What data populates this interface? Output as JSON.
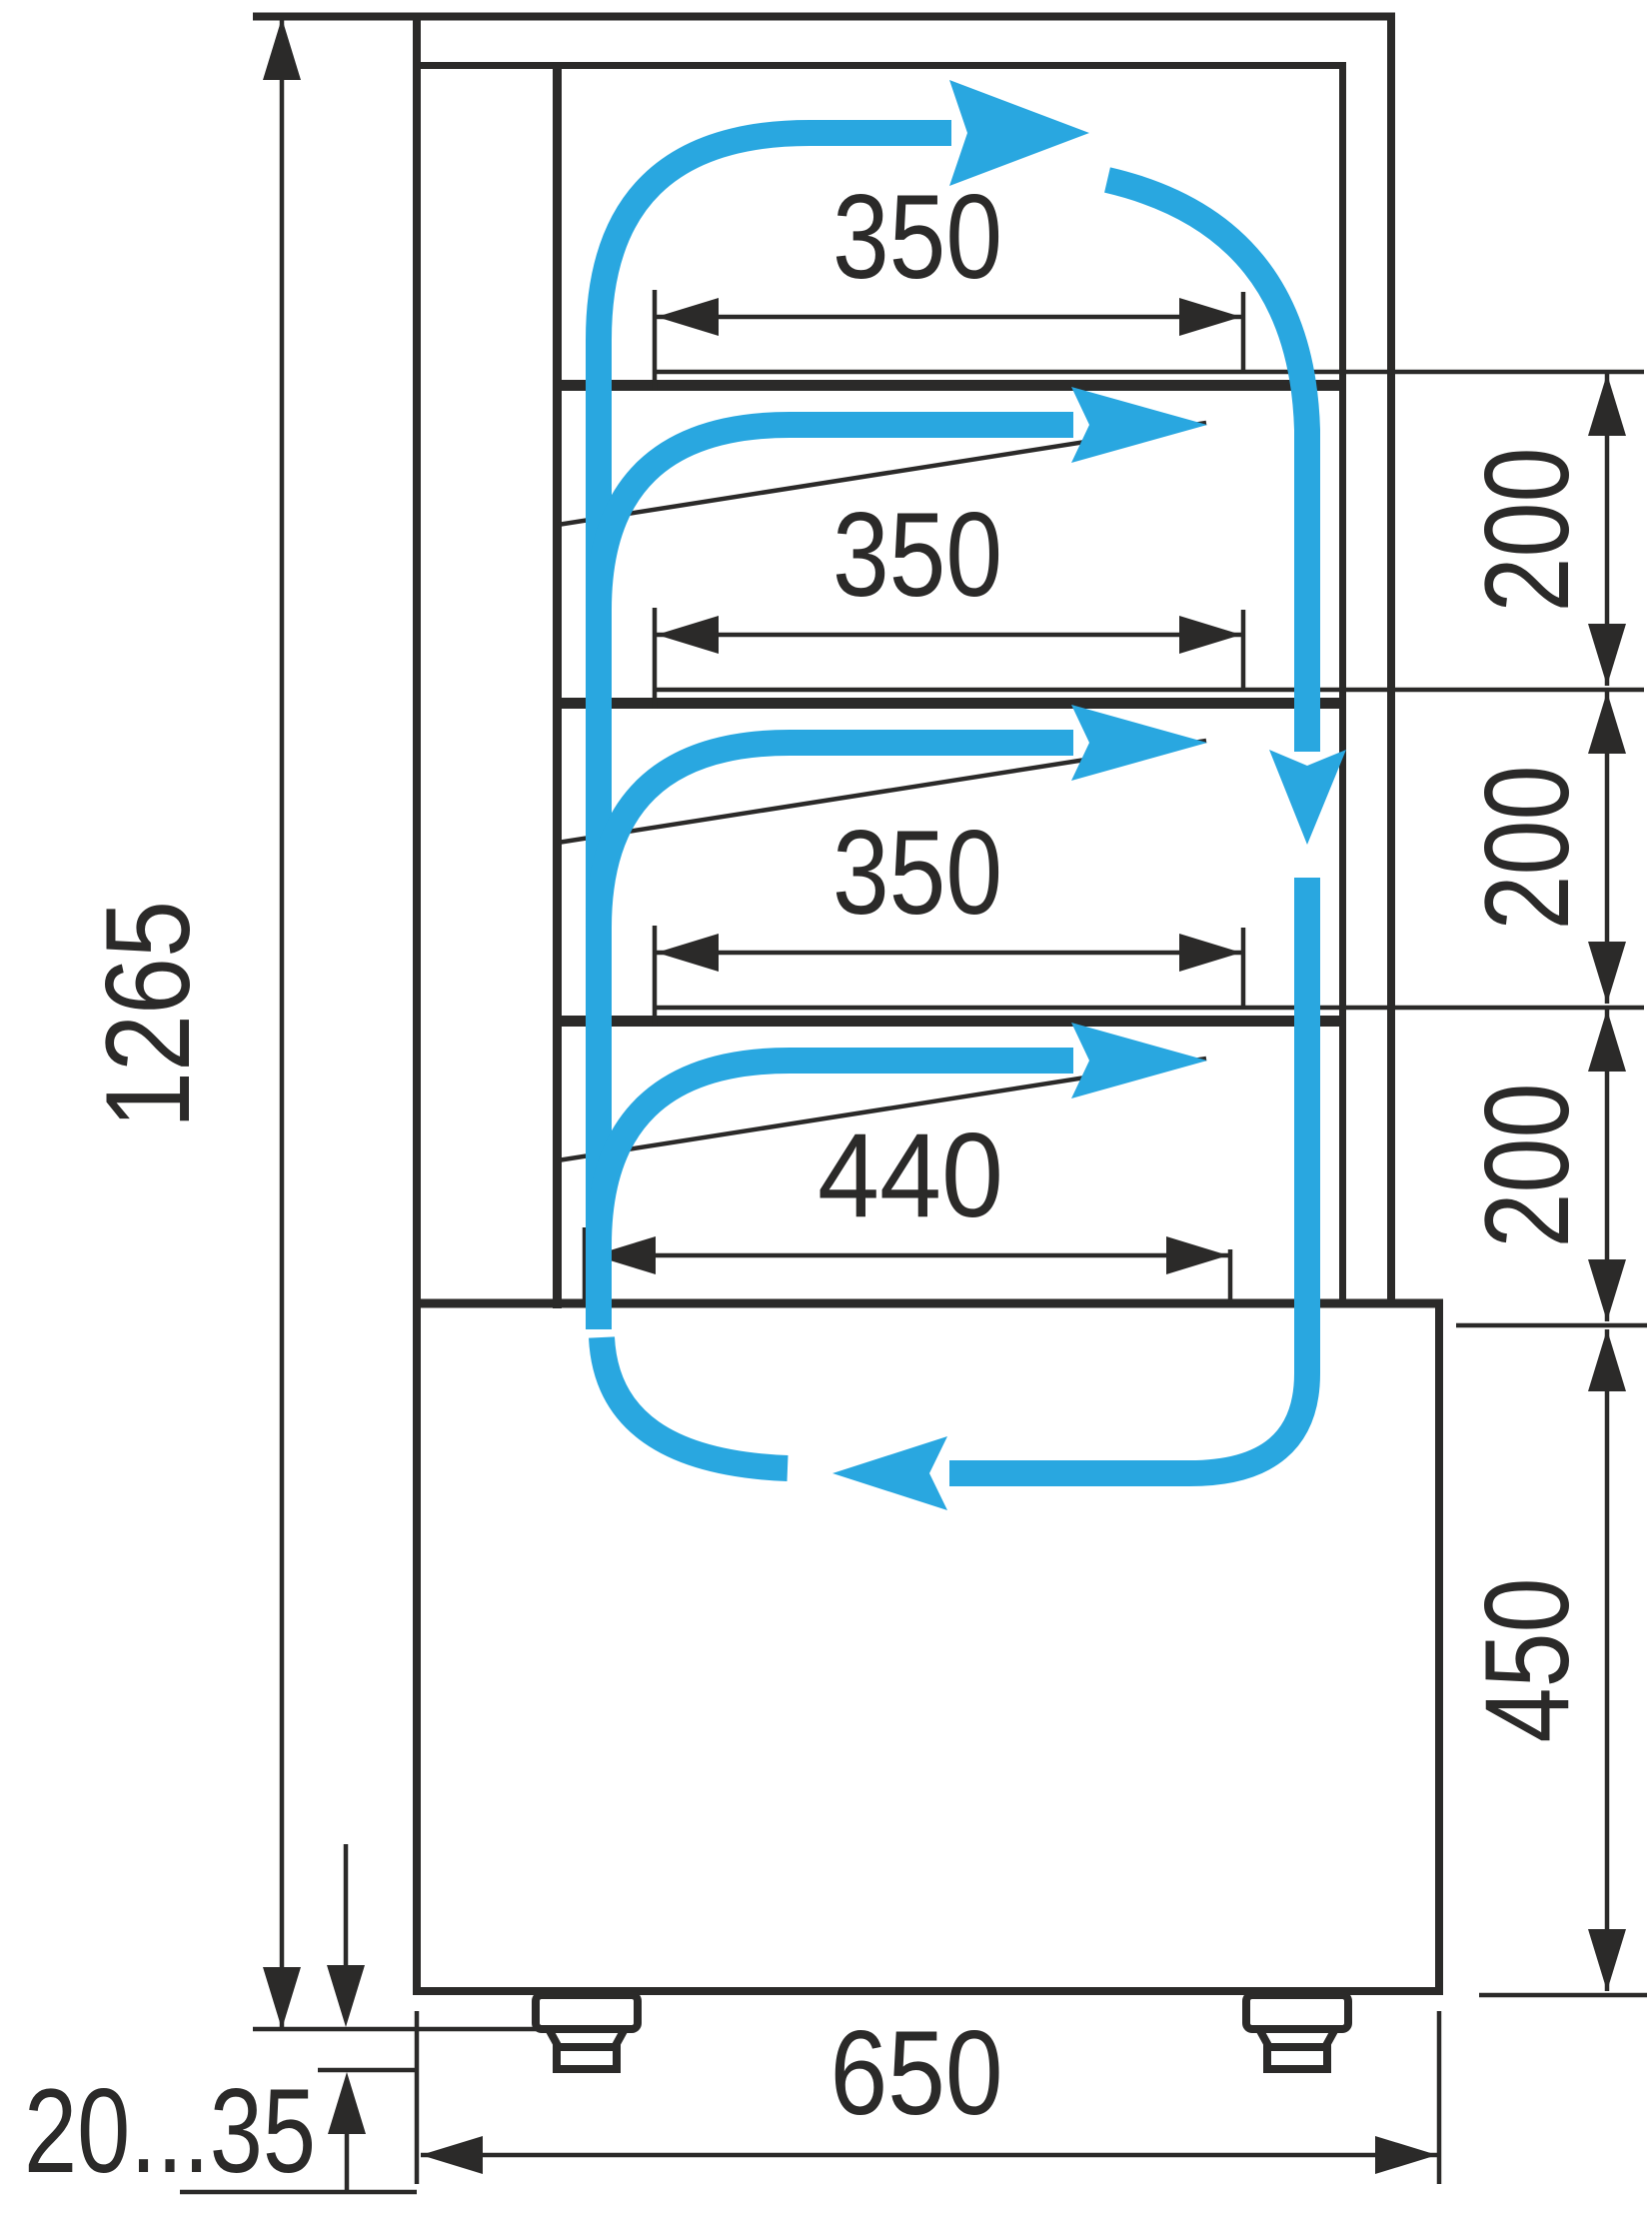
{
  "drawing": {
    "type": "technical-dimension-diagram",
    "subject": "refrigerated display case side section with air circulation",
    "colors": {
      "line": "#2B2A29",
      "airflow": "#29A7E0",
      "background": "#FFFFFF"
    },
    "dimensions": {
      "overall_height": "1265",
      "shelf_widths": [
        "350",
        "350",
        "350"
      ],
      "bottom_shelf_width": "440",
      "level_heights": [
        "200",
        "200",
        "200"
      ],
      "base_height": "450",
      "overall_depth": "650",
      "foot_height_range": "20...35"
    }
  }
}
